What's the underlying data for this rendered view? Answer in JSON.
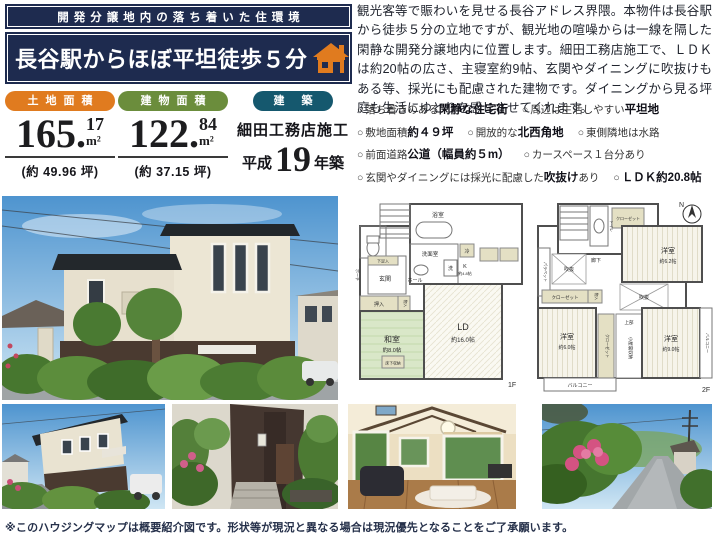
{
  "colors": {
    "navy": "#1e2b4f",
    "orange": "#e07b1f",
    "green": "#6b8d3c",
    "teal": "#15586e"
  },
  "header": {
    "tagline": "開発分譲地内の落ち着いた住環境",
    "title": "長谷駅からほぼ平坦徒歩５分",
    "icon": "house-icon"
  },
  "description": {
    "text": "観光客等で賑わいを見せる長谷アドレス界隈。本物件は長谷駅から徒歩５分の立地ですが、観光地の喧噪からは一線を隔した閑静な開発分譲地内に位置します。細田工務店施工で、ＬＤＫは約20帖の広さ、主寝室約9帖、玄関やダイニングに吹抜けもある等、採光にも配慮された建物です。ダイニングから見る坪庭も生活にゆとりを感じさせてくれます。"
  },
  "features": {
    "bullet": "○",
    "rows": [
      [
        {
          "pre": "落ち着きのある",
          "bold": "閑静な住宅街",
          "post": ""
        },
        {
          "pre": "周辺は生活しやすい",
          "bold": "平坦地",
          "post": ""
        }
      ],
      [
        {
          "pre": "敷地面積",
          "bold": "約４９坪",
          "post": ""
        },
        {
          "pre": "開放的な",
          "bold": "北西角地",
          "post": ""
        },
        {
          "pre": "東側隣地は水路",
          "bold": "",
          "post": ""
        }
      ],
      [
        {
          "pre": "前面道路",
          "bold": "公道（幅員約５m）",
          "post": ""
        },
        {
          "pre": "カースペース１台分あり",
          "bold": "",
          "post": ""
        }
      ],
      [
        {
          "pre": "玄関やダイニングには採光に配慮した",
          "bold": "吹抜け",
          "post": "あり"
        },
        {
          "pre": "",
          "bold": "ＬＤＫ約20.8帖",
          "post": ""
        }
      ]
    ]
  },
  "specs": [
    {
      "label": "土地面積",
      "color": "#e07b1f",
      "int": "165.",
      "dec": "17",
      "unit": "m²",
      "sub": "(約 49.96 坪)"
    },
    {
      "label": "建物面積",
      "color": "#6b8d3c",
      "int": "122.",
      "dec": "84",
      "unit": "m²",
      "sub": "(約 37.15 坪)"
    }
  ],
  "build": {
    "label": "建 築",
    "color": "#15586e",
    "builder": "細田工務店施工",
    "era": "平成",
    "year": "19",
    "suffix": "年築"
  },
  "floorplan_1f": {
    "floor_label": "1F",
    "rooms": {
      "bath": "浴室",
      "washroom": "洗面室",
      "washer": "洗",
      "fridge": "冷",
      "kitchen": "K",
      "kitchen_size": "約4.8帖",
      "shoe_box": "下足入",
      "entrance": "玄関",
      "hall": "ホール",
      "porch": "ポーチ",
      "oshiire": "押入",
      "monoire": "物入",
      "washitsu": "和室",
      "washitsu_size": "約8.0帖",
      "floor_storage": "床下収納",
      "ld": "LD",
      "ld_size": "約16.0帖"
    }
  },
  "floorplan_2f": {
    "floor_label": "2F",
    "compass": "N",
    "rooms": {
      "toilet": "トイレ",
      "closet": "クローゼット",
      "corridor": "廊下",
      "parapet": "パラペット",
      "void": "吹抜",
      "monoire": "物入",
      "bedroom1": "洋室",
      "bedroom1_size": "約6.2帖",
      "bedroom2": "洋室",
      "bedroom2_size": "約6.0帖",
      "bedroom3": "洋室",
      "bedroom3_size": "約9.0帖",
      "attic_upper": "上部",
      "attic": "小屋裏収納",
      "balcony": "バルコニー"
    }
  },
  "photos": {
    "main": "exterior-front",
    "thumb1": "exterior-corner",
    "thumb2": "entrance-approach",
    "thumb3": "living-dining-interior",
    "thumb4": "street-view"
  },
  "disclaimer": "※このハウジングマップは概要紹介図です。形状等が現況と異なる場合は現況優先となることをご了承願います。"
}
